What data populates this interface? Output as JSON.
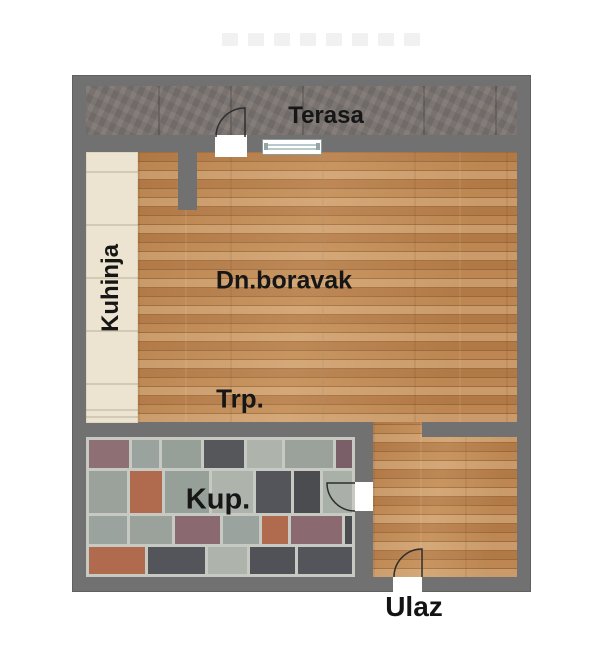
{
  "rooms": {
    "terrace": {
      "label": "Terasa"
    },
    "kitchen": {
      "label": "Kuhinja"
    },
    "living": {
      "label": "Dn.boravak"
    },
    "dining": {
      "label": "Trp."
    },
    "bathroom": {
      "label": "Kup."
    },
    "entrance": {
      "label": "Ulaz"
    }
  },
  "colors": {
    "wall": "#717171",
    "terrace_tile": "#7b7471",
    "kitchen_tile": "#ece4d0",
    "wood_base": "#c4915c",
    "bathroom_grout": "#c7c9c3",
    "label_text": "#161616",
    "bathroom_palette": [
      "#515257",
      "#9aa29b",
      "#4b4c50",
      "#aeb3ac",
      "#8e6f74",
      "#c75f41",
      "#56575b",
      "#96a098",
      "#7b5f68",
      "#a9b0a7",
      "#b06a4e",
      "#54555a",
      "#9aa39d",
      "#8a6a70"
    ]
  }
}
